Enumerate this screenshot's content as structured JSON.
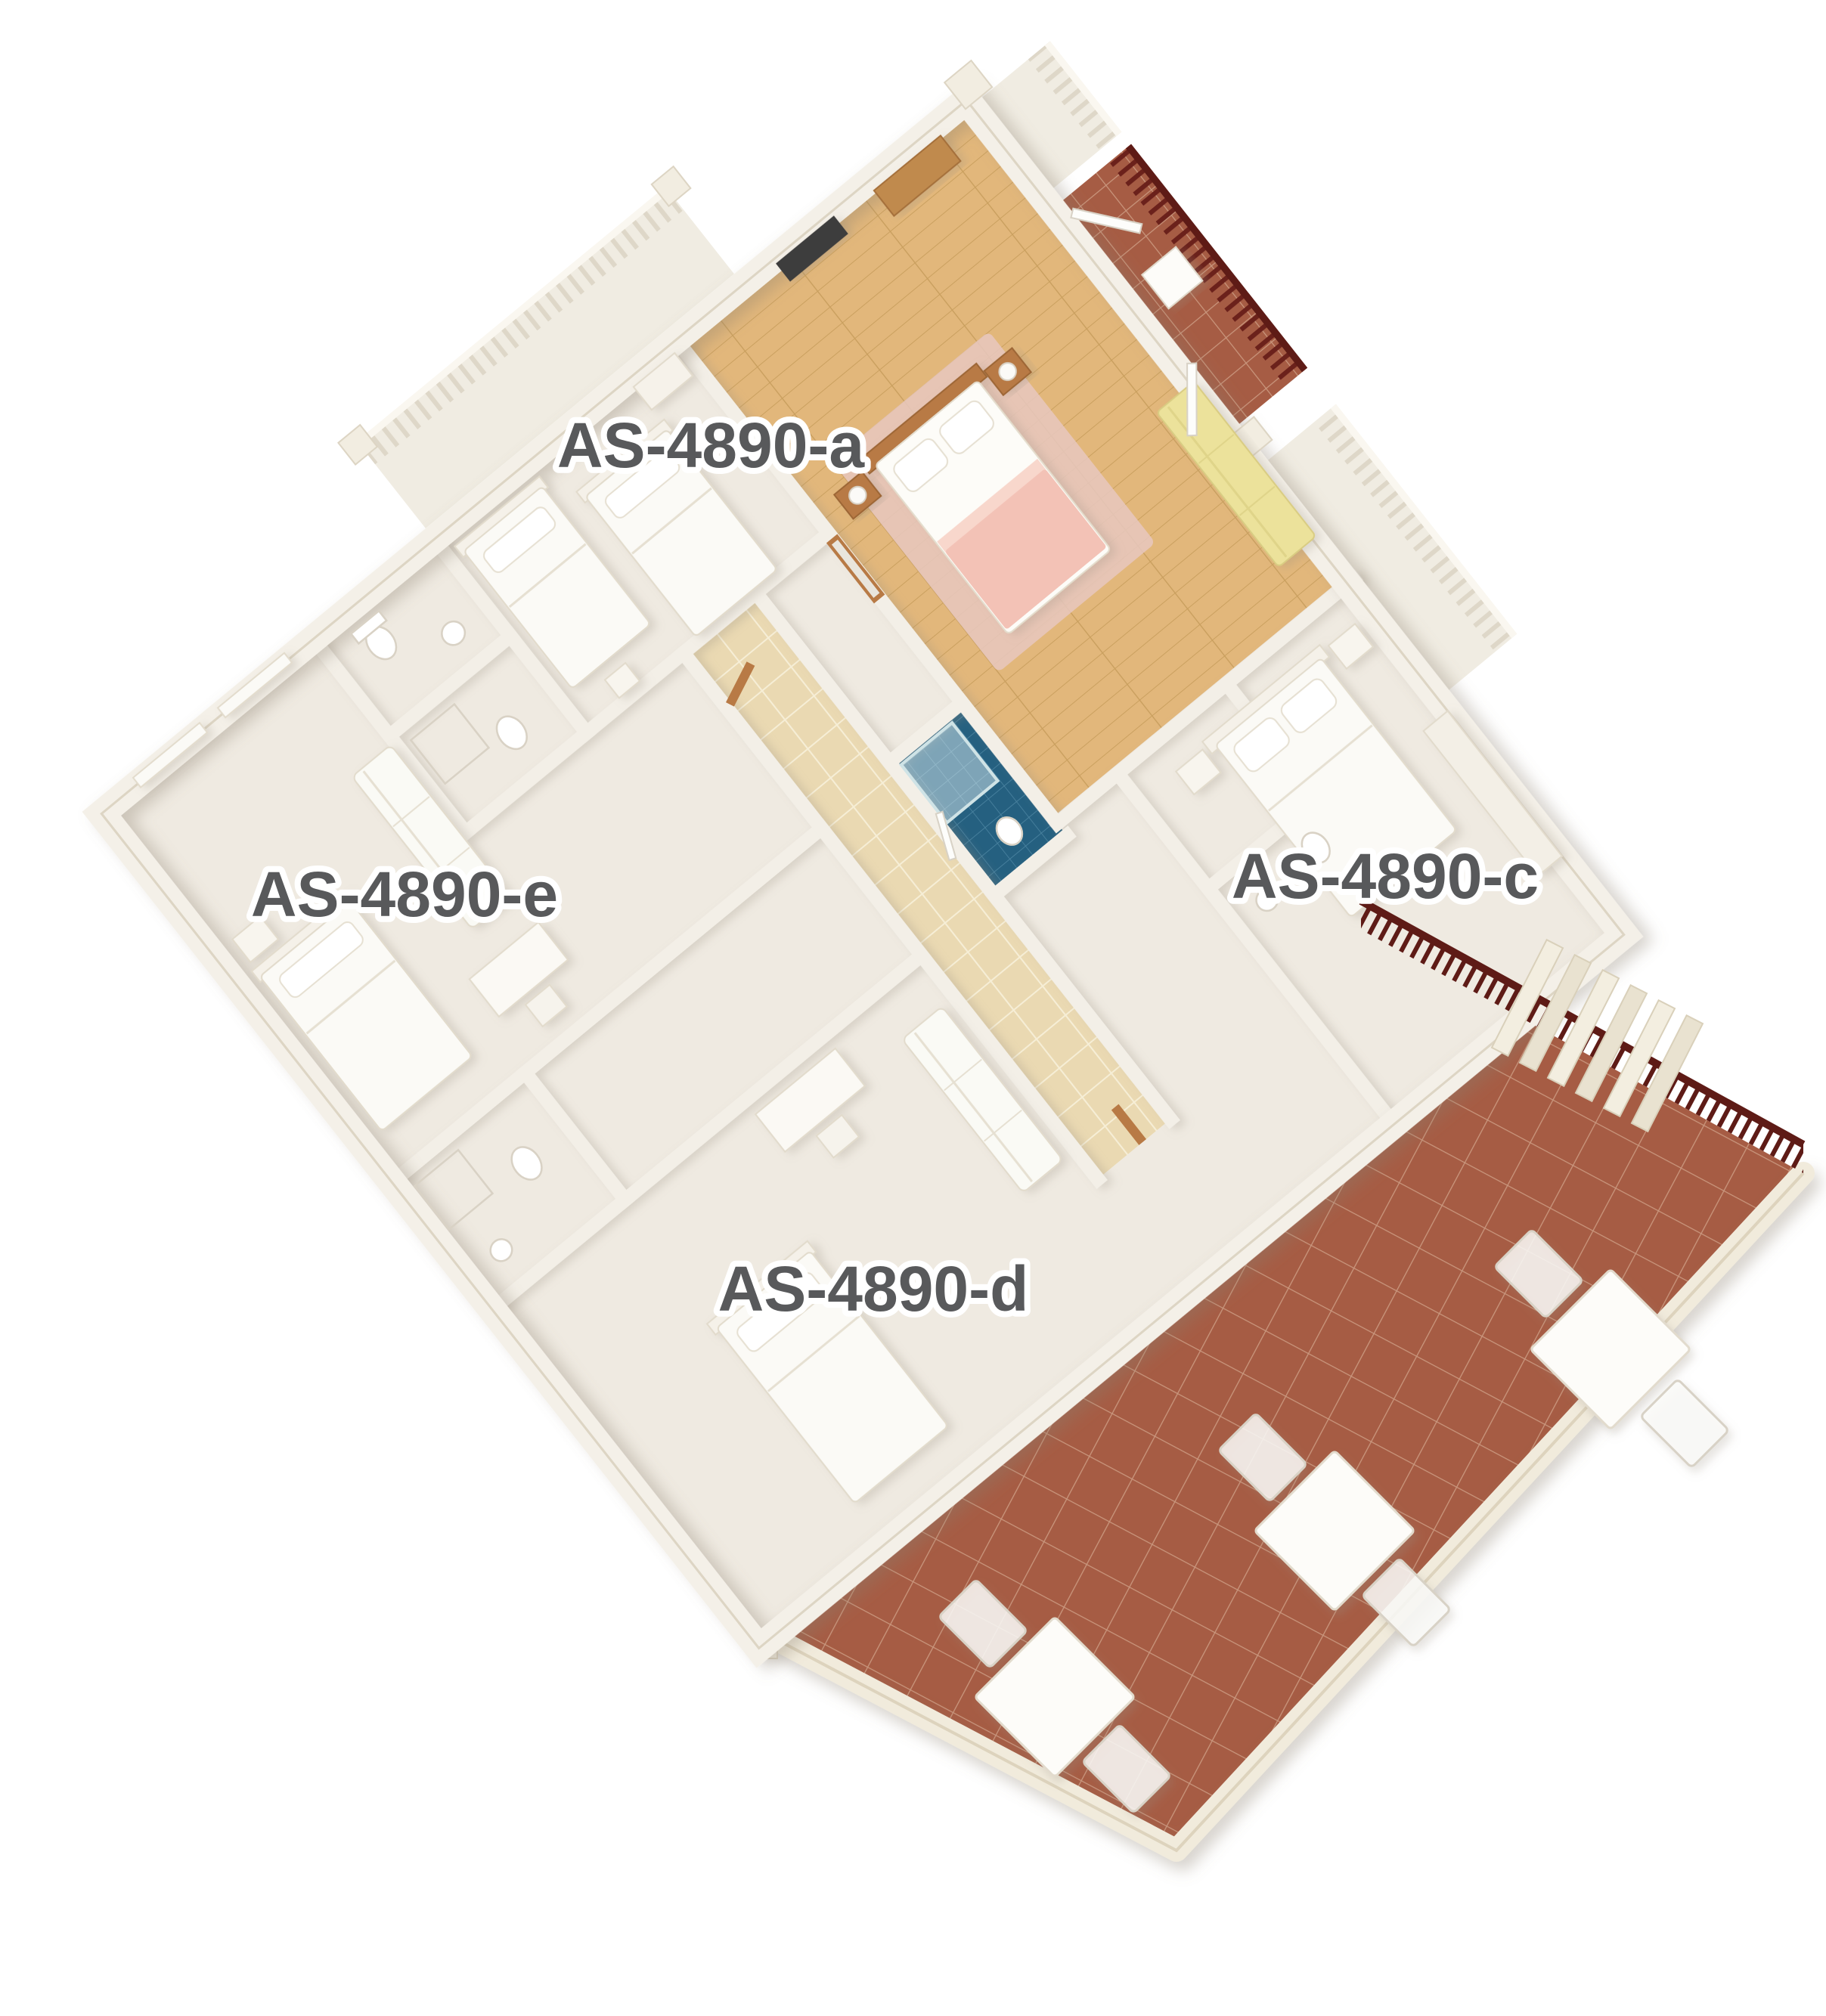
{
  "scene": {
    "type": "3d-floor-plan-rendering",
    "units": [
      {
        "id": "room-a",
        "label": "AS-4890-a"
      },
      {
        "id": "room-e",
        "label": "AS-4890-e"
      },
      {
        "id": "room-c",
        "label": "AS-4890-c"
      },
      {
        "id": "room-d",
        "label": "AS-4890-d"
      }
    ]
  },
  "colors": {
    "background": "#ffffff",
    "wall": "#f3efe7",
    "wall_edge": "#ddd5c4",
    "floor": "#efeae1",
    "hall_tile": "#ead9b2",
    "wood_floor": "#e2b77b",
    "blue_tile": "#256080",
    "terracotta": "#a65c44",
    "terracotta_grout": "#c9967d",
    "maroon_railing": "#5e1b16",
    "label_text": "#58595b",
    "pink_bedding": "#f3c2b6",
    "pink_rug": "#e8c8c0",
    "yellow_sofa": "#ece29b",
    "wood_furniture": "#b87a45"
  }
}
